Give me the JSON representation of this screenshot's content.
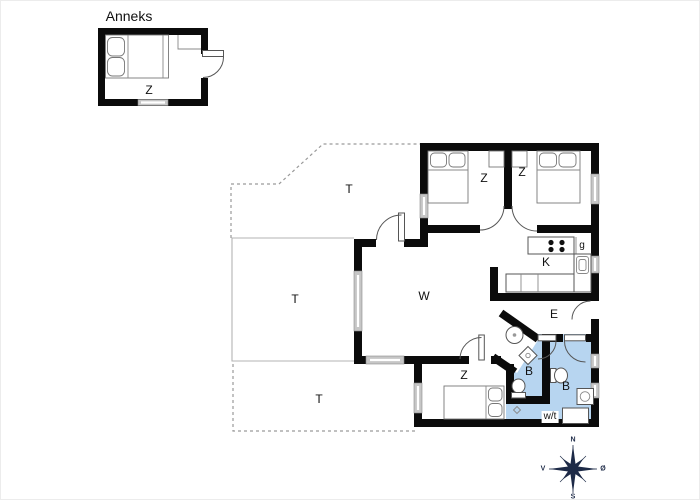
{
  "annex": {
    "title": "Anneks",
    "bedroom": "Z"
  },
  "house": {
    "bedroom_top_left": "Z",
    "bedroom_top_right": "Z",
    "kitchen": "K",
    "pantry": "g",
    "living_room": "W",
    "entry": "E",
    "bathroom_small": "B",
    "bathroom_large": "B",
    "bedroom_bottom": "Z",
    "utility_room": "w/t"
  },
  "terraces": {
    "north": "T",
    "west": "T",
    "south": "T"
  },
  "compass": {
    "north": "N",
    "south": "S",
    "west": "V",
    "east": "Ø"
  },
  "colors": {
    "bathroom_fill": "#b7d5f0",
    "wall": "#0b0b0b",
    "window_fill": "#c6c6c6",
    "compass_navy": "#1d2a47"
  }
}
